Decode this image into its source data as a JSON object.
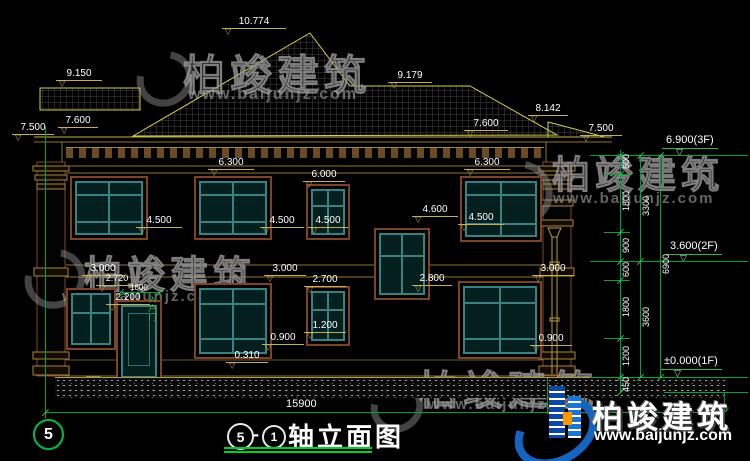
{
  "dims": {
    "ridge": "10.774",
    "porch_roof": "9.150",
    "flat_roof": "9.179",
    "sec_roof": "8.142",
    "eave_left": "7.500",
    "eave_right": "7.500",
    "slope_left": "7.600",
    "slope_right": "7.600",
    "belt_left": "6.300",
    "belt_right": "6.300",
    "small_head": "6.000",
    "sill2_1": "4.500",
    "sill2_2": "4.500",
    "sill2_3": "4.500",
    "sill2_4": "4.500",
    "stair_head": "4.600",
    "floor_1": "3.000",
    "floor_2": "3.000",
    "floor_3": "3.000",
    "stair_sill": "2.800",
    "win1_head": "2.700",
    "door_leader": "2.720",
    "door_head": "2.200",
    "door_width": "1800",
    "door_tag": "入户门",
    "win1_sill": "1.200",
    "sill1_1": "0.900",
    "sill1_2": "0.900",
    "plinth": "0.310",
    "total_width": "15900"
  },
  "levels": {
    "f3": "6.900(3F)",
    "f2": "3.600(2F)",
    "f1": "±0.000(1F)"
  },
  "chain": {
    "s600a": "600",
    "s1800a": "1800",
    "s900": "900",
    "s600b": "600",
    "s1800b": "1800",
    "s1200": "1200",
    "s450": "450",
    "s3300": "3300",
    "s3600": "3600",
    "s6900": "6900"
  },
  "titleblock": {
    "axis_bubble": "5",
    "bubble_start": "5",
    "dash": "-",
    "bubble_end": "1",
    "name": "轴立面图"
  },
  "brand": {
    "name": "柏竣建筑",
    "url": "www.baijunjz.com"
  }
}
